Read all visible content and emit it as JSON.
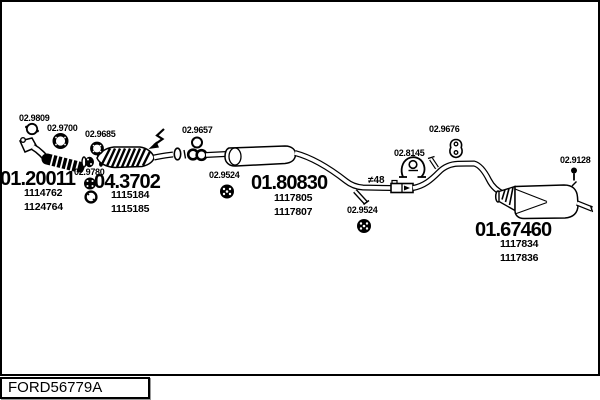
{
  "footer": {
    "reference": "FORD56779A"
  },
  "parts": {
    "main": [
      {
        "code": "01.20011",
        "subnumbers": [
          "1114762",
          "1124764"
        ]
      },
      {
        "code": "04.3702",
        "subnumbers": [
          "1115184",
          "1115185"
        ]
      },
      {
        "code": "01.80830",
        "subnumbers": [
          "1117805",
          "1117807"
        ]
      },
      {
        "code": "01.67460",
        "subnumbers": [
          "1117834",
          "1117836"
        ]
      }
    ],
    "small": [
      {
        "code": "02.9809"
      },
      {
        "code": "02.9700"
      },
      {
        "code": "02.9685"
      },
      {
        "code": "02.9780"
      },
      {
        "code": "02.9657"
      },
      {
        "code": "02.9524"
      },
      {
        "code": "02.9524"
      },
      {
        "code": "02.8145"
      },
      {
        "code": "02.9676"
      },
      {
        "code": "02.9128"
      }
    ],
    "annotation": "≠48"
  },
  "colors": {
    "line": "#000000",
    "background": "#ffffff"
  }
}
